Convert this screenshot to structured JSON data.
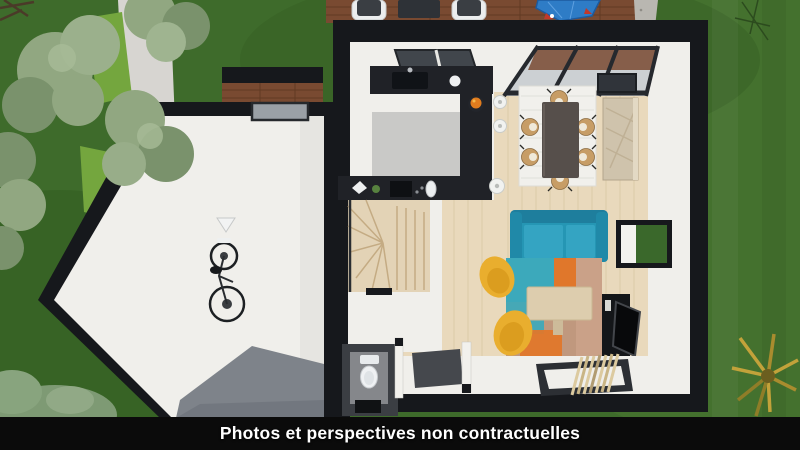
{
  "meta": {
    "kind": "3d-floor-plan-top-view-render",
    "width_px": 800,
    "height_px": 450
  },
  "caption": {
    "text": "Photos et perspectives non contractuelles"
  },
  "scene": {
    "outdoor_elements": [
      "lawn",
      "trees",
      "hedge",
      "footpath",
      "wood-deck-with-loungers",
      "blue-covered-object",
      "gravel-strip",
      "yellow-shrub"
    ],
    "garage_elements": [
      "wall-mounted-bicycle",
      "window",
      "concrete-floor"
    ],
    "house_elements": [
      "kitchen-black-l-counter",
      "sink",
      "fruit-bowl",
      "bar-stools",
      "glass-canopy",
      "dining-table",
      "six-chairs",
      "white-rug",
      "sideboard",
      "winder-staircase",
      "teal-sofa",
      "two-yellow-armchairs",
      "patchwork-rug",
      "coffee-table",
      "tv-unit",
      "window-to-garden",
      "wc-with-toilet",
      "doormat",
      "entry-slatted-mat"
    ]
  },
  "palette": {
    "grass": "#3e6b2b",
    "grassLight": "#4f7d35",
    "path": "#d7d5d1",
    "hedge": "#74a63e",
    "treeSage": "#91a781",
    "treeSageDark": "#7a926c",
    "deckWood": "#794a31",
    "deckLine": "#5c3720",
    "gravel": "#b9b7b1",
    "wallBlack": "#16181c",
    "interiorWhite": "#f0efeb",
    "kitchenGray": "#c9c9c7",
    "garageFloor": "#7e838a",
    "woodFloor": "#e9d9bc",
    "counterBlack": "#202227",
    "stairsWood": "#e3d3b6",
    "rugWhite": "#f1f0ec",
    "tableDark": "#564f4b",
    "chairWood": "#c79d66",
    "sideboard": "#cfc3ac",
    "sofaTeal": "#2596b4",
    "chairYellow": "#e9ae2e",
    "rugTan": "#c0987e",
    "rugTeal": "#3ca9bb",
    "rugOrange": "#e0772b",
    "coffeeWood": "#ddcdae",
    "tvBlack": "#141619",
    "windowGreen": "#3a682b",
    "wcFloor": "#85878b",
    "tarpBlue": "#2e7cc6",
    "fruitOrange": "#e07c1e",
    "plantYellow": "#c2a23a",
    "barBlack": "#0b0b0b",
    "captionText": "#ffffff"
  }
}
